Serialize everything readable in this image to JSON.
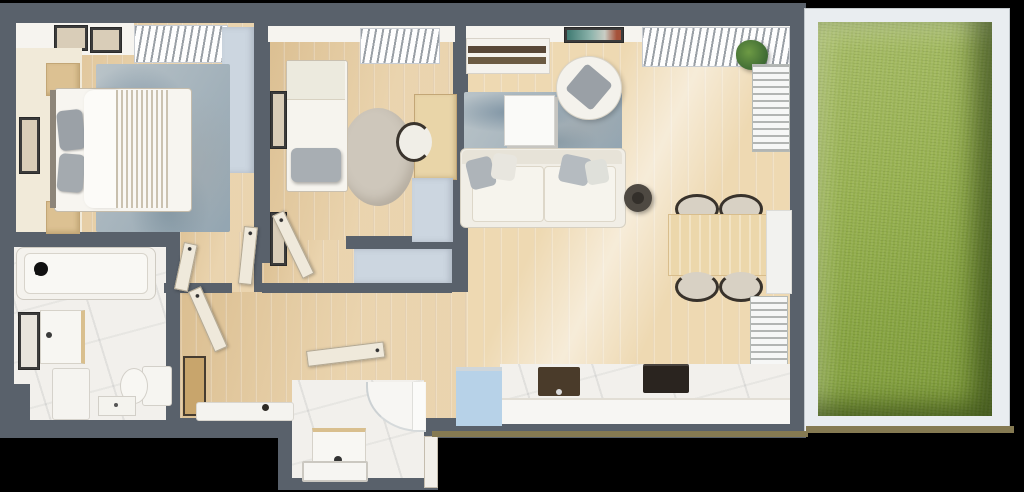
{
  "scene": {
    "description": "3D top-down architectural floor plan render of an apartment with garden terrace",
    "background": "#000000"
  },
  "colors": {
    "wall": "#59616b",
    "wood": "#e6cb9d",
    "woodLight": "#eed9b2",
    "marble": "#f2f0ec",
    "white": "#f6f4ef",
    "blueCabinet": "#ccd6e0",
    "blueBox": "#b7d2e8",
    "rug": "#a9b6be",
    "roundRug": "#cec7bb",
    "grass": "#93ae4e",
    "gardenFrame": "#e9edf0",
    "doorLeaf": "#efe9db",
    "tanLine": "#857a52",
    "darkFixture": "#2a241f"
  },
  "rooms": [
    {
      "id": "bedroom-1",
      "furniture": [
        "double-bed",
        "gray-pillows",
        "fringed-throw",
        "headboard",
        "nightstand-top",
        "nightstand-bottom",
        "blue-wardrobe",
        "distressed-area-rug",
        "cream-runner",
        "wall-art",
        "shelf-with-frames",
        "window-blinds"
      ]
    },
    {
      "id": "bedroom-2",
      "furniture": [
        "single-bed",
        "gray-pillow",
        "round-rug",
        "desk",
        "desk-chair",
        "blue-cabinet",
        "blue-niche-cabinet",
        "wall-frames",
        "window-blinds",
        "door-leaf"
      ]
    },
    {
      "id": "living-room",
      "furniture": [
        "sofa",
        "throw-pillows",
        "coffee-table",
        "area-rug",
        "armchair",
        "side-table",
        "tv-unit",
        "wall-art",
        "dining-table",
        "dining-chairs-x4",
        "console",
        "radiator-top",
        "radiator-bottom",
        "potted-plant",
        "window-blinds"
      ]
    },
    {
      "id": "kitchen",
      "furniture": [
        "marble-counter",
        "sink",
        "cooktop",
        "blue-cabinet"
      ]
    },
    {
      "id": "bathroom",
      "furniture": [
        "bathtub",
        "black-faucet",
        "mirror",
        "vanity-sink",
        "washing-machine",
        "toilet",
        "storage-box"
      ]
    },
    {
      "id": "hallway",
      "furniture": [
        "entrance-door-leaf",
        "doormat",
        "leaning-mirror",
        "door-leaves"
      ]
    },
    {
      "id": "shower-room",
      "furniture": [
        "curved-shower",
        "vanity-sink",
        "bath-mat",
        "door-leaf"
      ]
    },
    {
      "id": "garden-terrace",
      "furniture": [
        "lawn",
        "white-border-frame"
      ]
    }
  ]
}
